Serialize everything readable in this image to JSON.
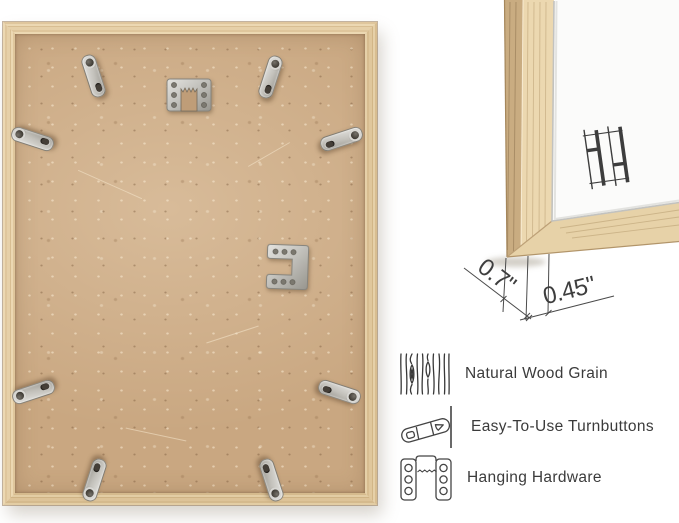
{
  "image_type": "product-infographic",
  "product_photo": {
    "subject": "picture frame back",
    "frame_finish": "natural oak wood",
    "turnbutton_count": 8,
    "hangers": [
      "sawtooth-hanger",
      "hanging-bracket"
    ]
  },
  "closeup": {
    "subject": "frame corner close-up with white mat",
    "brand_mark": "HH monogram"
  },
  "dimensions": {
    "frame_depth": "0.7\"",
    "frame_face": "0.45\""
  },
  "features": [
    {
      "icon": "wood-grain-icon",
      "label": "Natural Wood Grain"
    },
    {
      "icon": "turnbutton-icon",
      "label": "Easy-To-Use Turnbuttons"
    },
    {
      "icon": "hanging-hardware-icon",
      "label": "Hanging Hardware"
    }
  ],
  "colors": {
    "wood": "#e6d0a8",
    "wood_shadow": "#c9ac81",
    "backboard": "#c9a781",
    "metal": "#c6c5c0",
    "text": "#3b3b3b",
    "dimension_line": "#4a4a4a",
    "background": "#ffffff"
  }
}
